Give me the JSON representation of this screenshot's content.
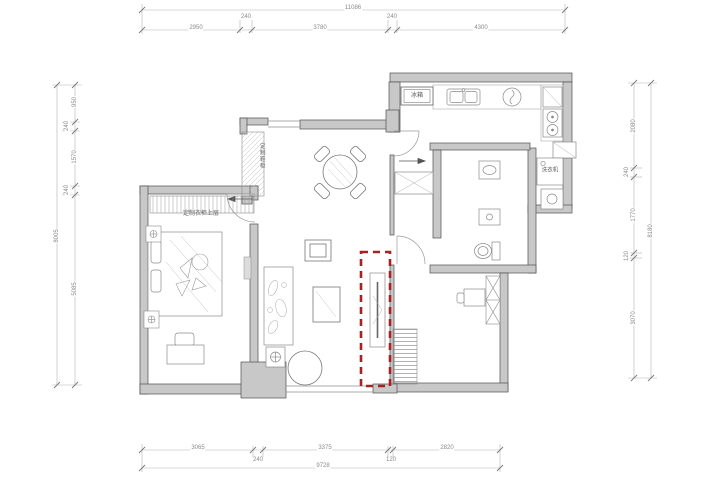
{
  "drawing": {
    "type": "apartment-floor-plan",
    "wall_color": "#c8c8c8",
    "line_color": "#8f8f8f"
  },
  "highlight": {
    "color": "#a82222",
    "style": "dashed-rectangle"
  },
  "dims": {
    "top": {
      "total": "11086",
      "segments": [
        "2950",
        "240",
        "3780",
        "240",
        "4300"
      ]
    },
    "bottom": {
      "total": "9728",
      "segments": [
        "3065",
        "240",
        "3375",
        "120",
        "2820"
      ]
    },
    "left": {
      "total": "8005",
      "segments": [
        "950",
        "240",
        "1570",
        "240",
        "5085"
      ]
    },
    "right": {
      "total": "8180",
      "segments": [
        "2080",
        "240",
        "1770",
        "120",
        "3070"
      ]
    }
  },
  "labels": {
    "fridge": "冰箱",
    "washing_machine": "洗衣机",
    "shoe_cabinet": "定制鞋柜",
    "wardrobe_upper": "定制衣柜上层"
  }
}
